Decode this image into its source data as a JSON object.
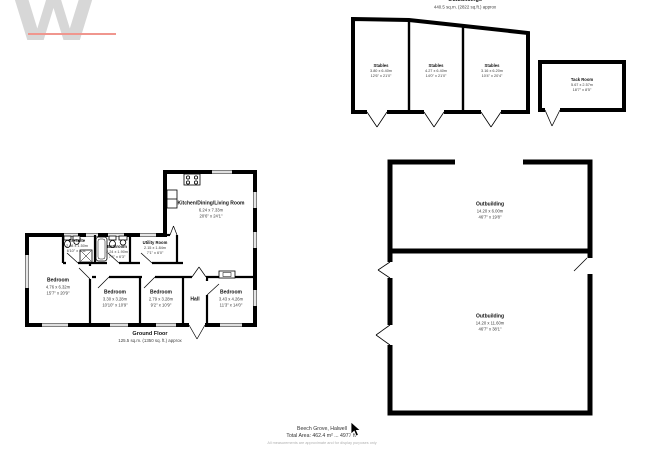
{
  "logo": {
    "letter": "W",
    "accent_color": "#f0968e",
    "gray_color": "#d7d7d7"
  },
  "outbuildings": {
    "header": {
      "title": "Outbuildings",
      "area": "440.5 sq.m. (2822 sq.ft.) approx"
    },
    "stables": [
      {
        "name": "Stables",
        "metric": "3.80 x 6.40m",
        "imperial": "12'6\" x 21'0\""
      },
      {
        "name": "Stables",
        "metric": "4.27 x 6.40m",
        "imperial": "14'0\" x 21'0\""
      },
      {
        "name": "Stables",
        "metric": "3.16 x 6.20m",
        "imperial": "10'4\" x 20'4\""
      }
    ],
    "tack": {
      "name": "Tack Room",
      "metric": "5.67 x 2.57m",
      "imperial": "18'7\" x 8'5\""
    },
    "upper": {
      "name": "Outbuilding",
      "metric": "14.20 x 6.00m",
      "imperial": "46'7\" x 19'8\""
    },
    "lower": {
      "name": "Outbuilding",
      "metric": "14.20 x 11.60m",
      "imperial": "46'7\" x 38'1\""
    }
  },
  "house": {
    "kitchen": {
      "name": "Kitchen/Dining/Living Room",
      "metric": "6.24 x 7.33m",
      "imperial": "20'6\" x 24'1\""
    },
    "utility": {
      "name": "Utility Room",
      "metric": "2.15 x 1.84m",
      "imperial": "7'1\" x 6'0\""
    },
    "ensuite": {
      "name": "En suite",
      "metric": "2.08 x 1.50m",
      "imperial": "6'10\" x 4'11\""
    },
    "bathroom": {
      "name": "Bathroom",
      "metric": "2.24 x 1.90m",
      "imperial": "7'4\" x 6'3\""
    },
    "master": {
      "name": "Bedroom",
      "metric": "4.76 x 6.32m",
      "imperial": "15'7\" x 20'9\""
    },
    "bed2": {
      "name": "Bedroom",
      "metric": "3.30 x 3.28m",
      "imperial": "10'10\" x 10'9\""
    },
    "bed3": {
      "name": "Bedroom",
      "metric": "2.79 x 3.28m",
      "imperial": "9'2\" x 10'9\""
    },
    "bed4": {
      "name": "Bedroom",
      "metric": "3.43 x 4.26m",
      "imperial": "11'3\" x 14'0\""
    },
    "hall": {
      "name": "Hall"
    },
    "floor": {
      "label": "Ground Floor",
      "area": "125.5 sq.m. (1350 sq. ft.) approx"
    }
  },
  "footer": {
    "line1": "Beech Grove, Halwell",
    "line2": "Total Area: 462.4 m² ... 4977 ft²",
    "line3": "All measurements are approximate and for display purposes only"
  }
}
